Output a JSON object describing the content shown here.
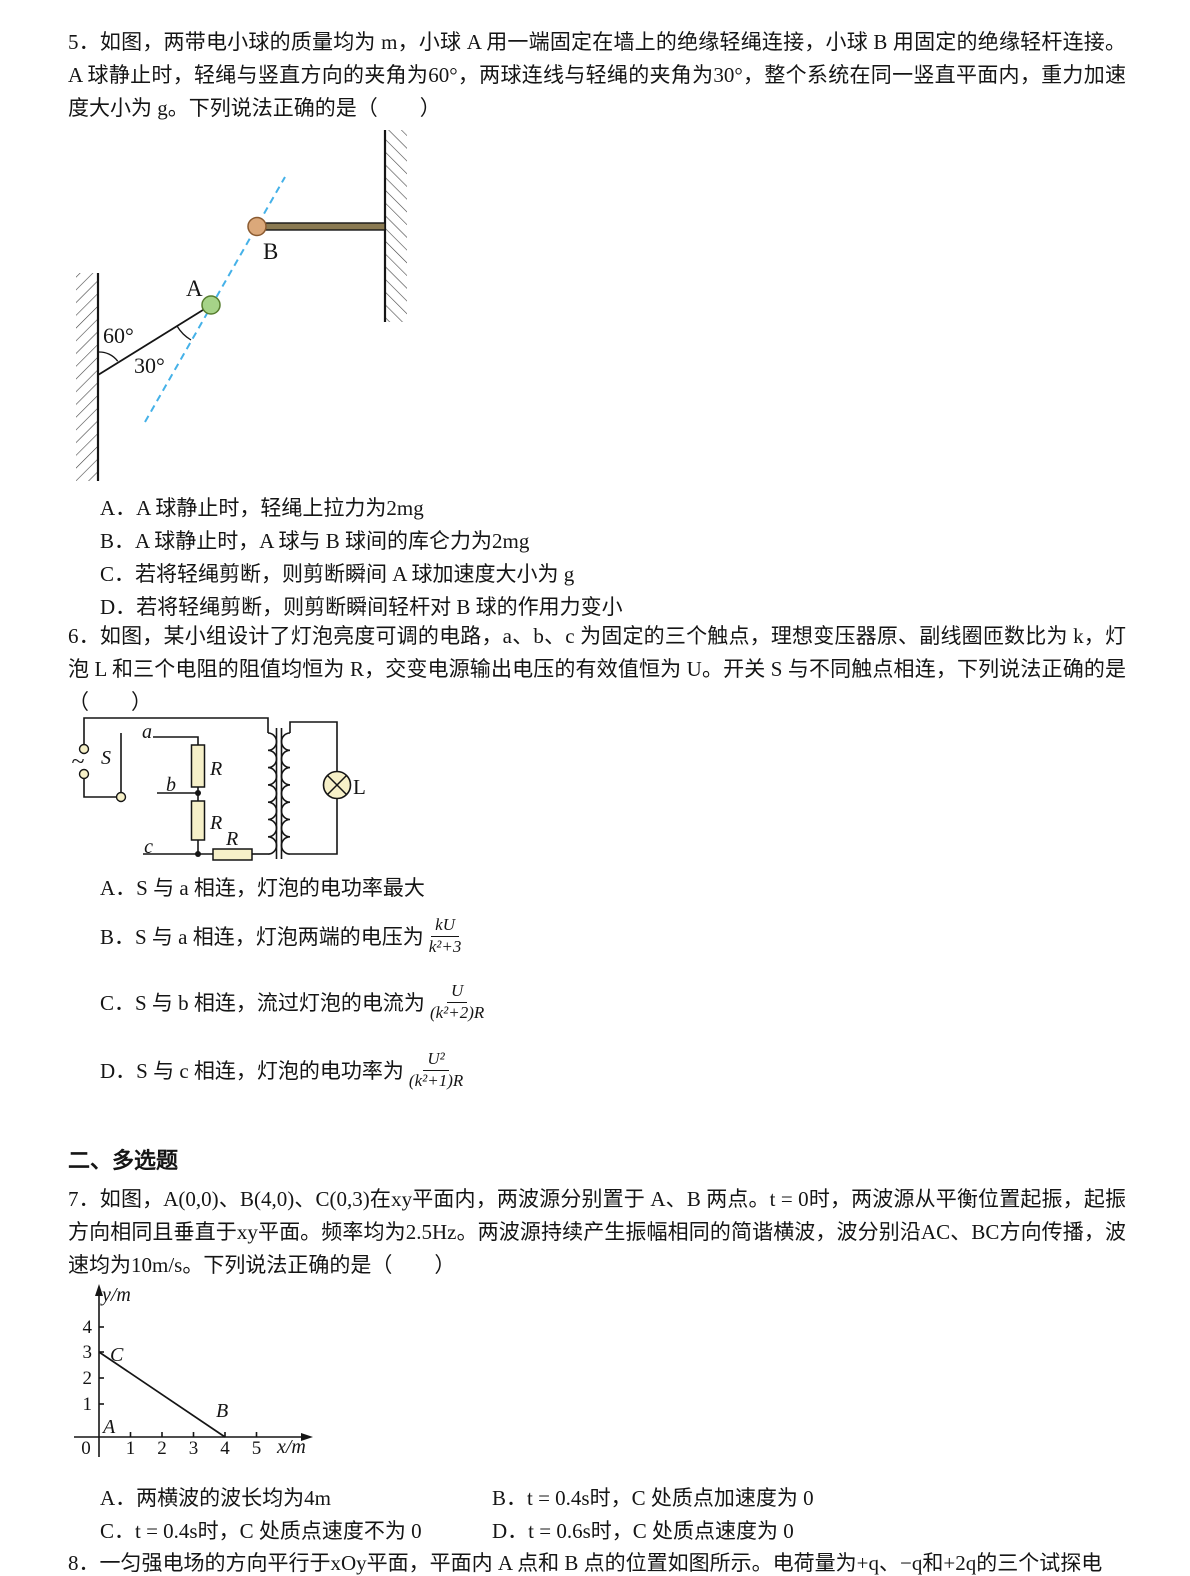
{
  "q5": {
    "text": "5．如图，两带电小球的质量均为 m，小球 A 用一端固定在墙上的绝缘轻绳连接，小球 B 用固定的绝缘轻杆连接。A 球静止时，轻绳与竖直方向的夹角为60°，两球连线与轻绳的夹角为30°，整个系统在同一竖直平面内，重力加速度大小为 g。下列说法正确的是（　　）",
    "diagram": {
      "label_a": "A",
      "label_b": "B",
      "angle_wall": "60°",
      "angle_rope": "30°",
      "ball_a_color": "#a6d388",
      "ball_b_color": "#dba87a",
      "dashed_line_color": "#45b1e8"
    },
    "options": [
      "A．A 球静止时，轻绳上拉力为2mg",
      "B．A 球静止时，A 球与 B 球间的库仑力为2mg",
      "C．若将轻绳剪断，则剪断瞬间 A 球加速度大小为 g",
      "D．若将轻绳剪断，则剪断瞬间轻杆对 B 球的作用力变小"
    ]
  },
  "q6": {
    "text": "6．如图，某小组设计了灯泡亮度可调的电路，a、b、c 为固定的三个触点，理想变压器原、副线圈匝数比为 k，灯泡 L 和三个电阻的阻值均恒为 R，交变电源输出电压的有效值恒为 U。开关 S 与不同触点相连，下列说法正确的是（　　）",
    "circuit": {
      "source": "~",
      "switch": "S",
      "contact_a": "a",
      "contact_b": "b",
      "contact_c": "c",
      "r1": "R",
      "r2": "R",
      "r3": "R",
      "lamp": "L",
      "component_fill": "#f6f0c8"
    },
    "options": [
      {
        "label": "A．S 与 a 相连，灯泡的电功率最大"
      },
      {
        "label": "B．S 与 a 相连，灯泡两端的电压为",
        "num": "kU",
        "den": "k²+3"
      },
      {
        "label": "C．S 与 b 相连，流过灯泡的电流为",
        "num": "U",
        "den": "(k²+2)R"
      },
      {
        "label": "D．S 与 c 相连，灯泡的电功率为",
        "num": "U²",
        "den": "(k²+1)R"
      }
    ]
  },
  "section2": {
    "title": "二、多选题"
  },
  "q7": {
    "text": "7．如图，A(0,0)、B(4,0)、C(0,3)在xy平面内，两波源分别置于 A、B 两点。t = 0时，两波源从平衡位置起振，起振方向相同且垂直于xy平面。频率均为2.5Hz。两波源持续产生振幅相同的简谐横波，波分别沿AC、BC方向传播，波速均为10m/s。下列说法正确的是（　　）",
    "graph": {
      "type": "line",
      "ylabel": "y/m",
      "xlabel": "x/m",
      "origin": "0",
      "xticks": [
        "1",
        "2",
        "3",
        "4",
        "5"
      ],
      "yticks": [
        "1",
        "2",
        "3",
        "4"
      ],
      "points": [
        {
          "name": "A",
          "x": 0,
          "y": 0
        },
        {
          "name": "B",
          "x": 4,
          "y": 0
        },
        {
          "name": "C",
          "x": 0,
          "y": 3
        }
      ],
      "segment": "C(0,3) to B(4,0)"
    },
    "options": [
      "A．两横波的波长均为4m",
      "B．t = 0.4s时，C 处质点加速度为 0",
      "C．t = 0.4s时，C 处质点速度不为 0",
      "D．t = 0.6s时，C 处质点速度为 0"
    ]
  },
  "q8": {
    "text": "8．一匀强电场的方向平行于xOy平面，平面内 A 点和 B 点的位置如图所示。电荷量为+q、−q和+2q的三个试探电"
  }
}
